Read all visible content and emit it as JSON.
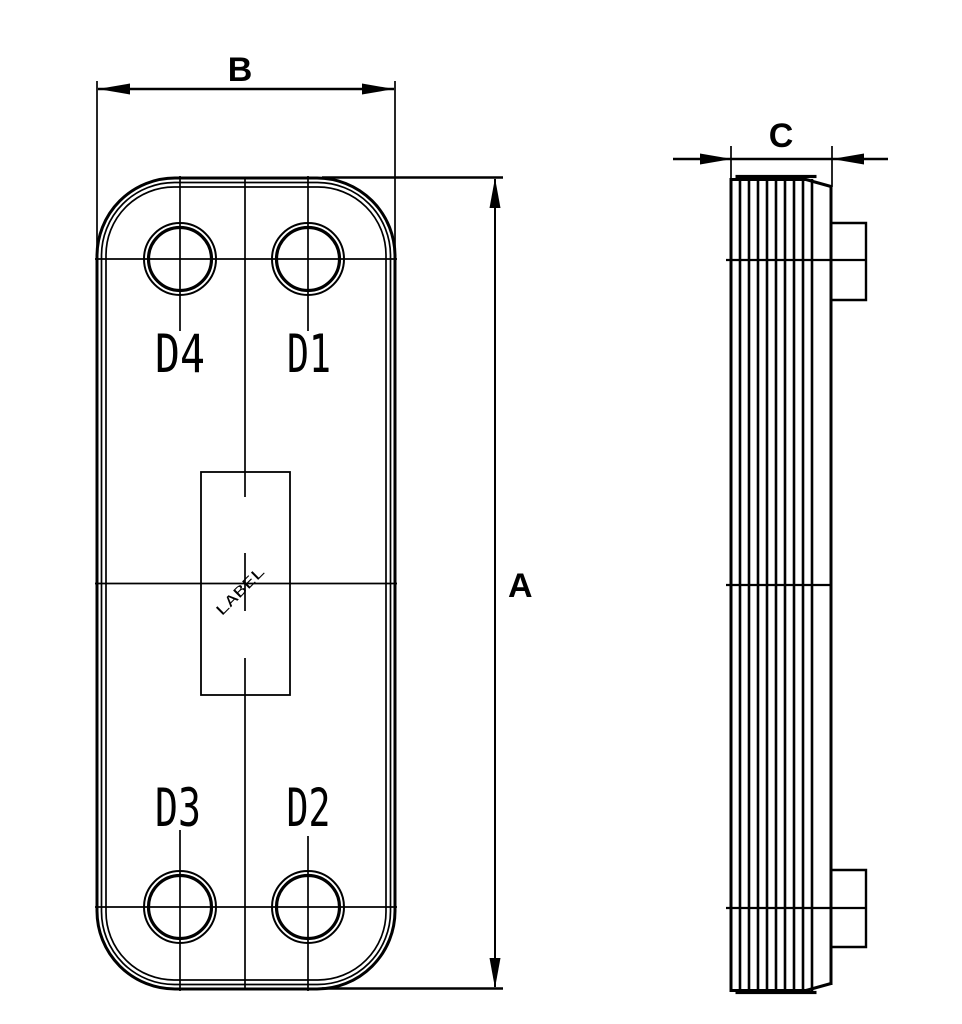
{
  "page": {
    "background": "#ffffff"
  },
  "colors": {
    "line": "#000000"
  },
  "dimensions": {
    "height": {
      "label": "A"
    },
    "width": {
      "label": "B"
    },
    "depth": {
      "label": "C"
    }
  },
  "front_view": {
    "ports": [
      {
        "label": "D4",
        "position": "top-left"
      },
      {
        "label": "D1",
        "position": "top-right"
      },
      {
        "label": "D3",
        "position": "bottom-left"
      },
      {
        "label": "D2",
        "position": "bottom-right"
      }
    ],
    "label_plate": {
      "text": "LABEL"
    }
  },
  "side_view": {
    "plate_line_count": 9,
    "connection_stubs": 2
  }
}
